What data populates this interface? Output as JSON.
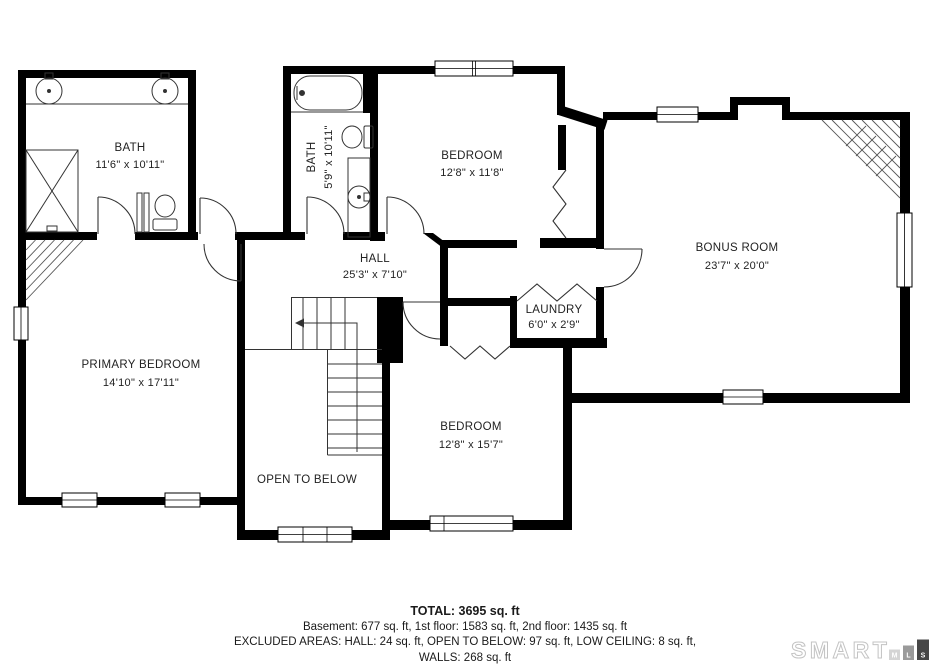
{
  "floor_plan": {
    "rooms": {
      "bath_main": {
        "label": "BATH",
        "dims": "11'6\" x 10'11\""
      },
      "bath_small": {
        "label": "BATH",
        "dims": "5'9\" x 10'11\""
      },
      "bedroom_top": {
        "label": "BEDROOM",
        "dims": "12'8\" x 11'8\""
      },
      "bonus_room": {
        "label": "BONUS ROOM",
        "dims": "23'7\" x 20'0\""
      },
      "hall": {
        "label": "HALL",
        "dims": "25'3\" x 7'10\""
      },
      "laundry": {
        "label": "LAUNDRY",
        "dims": "6'0\" x 2'9\""
      },
      "primary_bedroom": {
        "label": "PRIMARY BEDROOM",
        "dims": "14'10\" x 17'11\""
      },
      "bedroom_bottom": {
        "label": "BEDROOM",
        "dims": "12'8\" x 15'7\""
      },
      "open_to_below": {
        "label": "OPEN TO BELOW"
      }
    }
  },
  "summary": {
    "total": "TOTAL: 3695 sq. ft",
    "floors": "Basement: 677 sq. ft, 1st floor: 1583 sq. ft, 2nd floor: 1435 sq. ft",
    "excluded": "EXCLUDED AREAS: HALL: 24 sq. ft, OPEN TO BELOW: 97 sq. ft, LOW CEILING: 8 sq. ft,",
    "walls": "WALLS: 268 sq. ft"
  },
  "logo": {
    "brand": "SMART",
    "blocks": [
      {
        "letter": "M",
        "color": "#d4d4d4"
      },
      {
        "letter": "L",
        "color": "#9a9a9a"
      },
      {
        "letter": "S",
        "color": "#474747"
      }
    ]
  },
  "colors": {
    "wall": "#000000",
    "thin_line": "#333333",
    "hatch": "#555555",
    "text": "#222222",
    "logo_outline": "#c3c3c3"
  }
}
